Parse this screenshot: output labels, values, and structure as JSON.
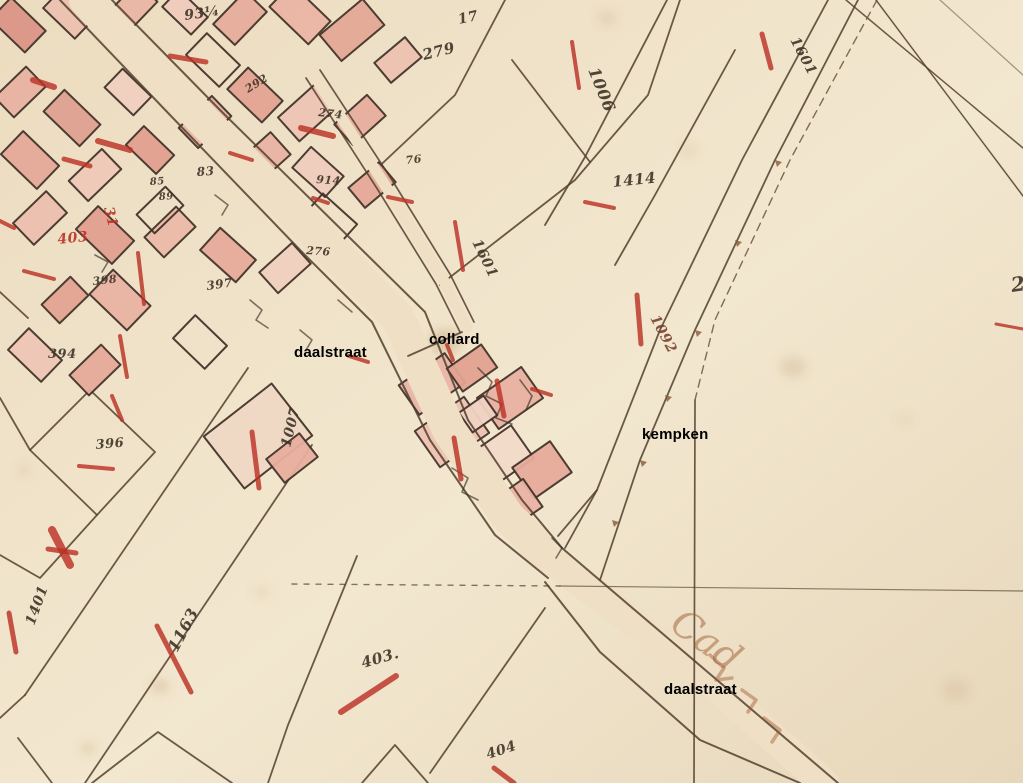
{
  "map_type": "historical cadastral map (scanned parchment with overlaid street/owner labels)",
  "palette": {
    "parchment": "#eedfc5",
    "parchment_light": "#f2e7cf",
    "parchment_dark": "#e7d7ba",
    "ink": "#52402e",
    "number_ink": "#3e3427",
    "building_fill": "#e9b6a8",
    "building_stroke": "#43332a",
    "red_ink": "#bb3226",
    "brown_ink": "#6b5340",
    "marginalia_ink": "#a05c34",
    "label_color": "#000000"
  },
  "labels": [
    {
      "text": "daalstraat",
      "x": 294,
      "y": 344
    },
    {
      "text": "collard",
      "x": 429,
      "y": 331
    },
    {
      "text": "kempken",
      "x": 642,
      "y": 426
    },
    {
      "text": "daalstraat",
      "x": 664,
      "y": 681
    }
  ],
  "marginalia": {
    "text": "Cad",
    "x": 668,
    "y": 628,
    "rot": 36,
    "size": 38
  },
  "numbers": [
    {
      "t": "93¼",
      "x": 185,
      "y": 20,
      "r": -8,
      "s": 14
    },
    {
      "t": "17",
      "x": 459,
      "y": 24,
      "r": -12,
      "s": 14
    },
    {
      "t": "279",
      "x": 424,
      "y": 60,
      "r": -14,
      "s": 15
    },
    {
      "t": "1006",
      "x": 588,
      "y": 70,
      "r": 68,
      "s": 16
    },
    {
      "t": "1601",
      "x": 790,
      "y": 40,
      "r": 62,
      "s": 14
    },
    {
      "t": "1601",
      "x": 472,
      "y": 242,
      "r": 64,
      "s": 14
    },
    {
      "t": "1414",
      "x": 613,
      "y": 187,
      "r": -6,
      "s": 15
    },
    {
      "t": "1092",
      "x": 650,
      "y": 318,
      "r": 62,
      "s": 14,
      "c": "#7a4331"
    },
    {
      "t": "26",
      "x": 1012,
      "y": 292,
      "r": -8,
      "s": 20
    },
    {
      "t": "83",
      "x": 197,
      "y": 176,
      "r": -4,
      "s": 12
    },
    {
      "t": "85",
      "x": 150,
      "y": 185,
      "r": -4,
      "s": 10
    },
    {
      "t": "89",
      "x": 159,
      "y": 200,
      "r": -4,
      "s": 10
    },
    {
      "t": "398",
      "x": 93,
      "y": 285,
      "r": -6,
      "s": 11
    },
    {
      "t": "397",
      "x": 207,
      "y": 290,
      "r": -8,
      "s": 12
    },
    {
      "t": "394",
      "x": 48,
      "y": 358,
      "r": 0,
      "s": 13
    },
    {
      "t": "274",
      "x": 318,
      "y": 116,
      "r": 6,
      "s": 11
    },
    {
      "t": "914",
      "x": 316,
      "y": 183,
      "r": 4,
      "s": 11
    },
    {
      "t": "76",
      "x": 406,
      "y": 164,
      "r": -6,
      "s": 11
    },
    {
      "t": "276",
      "x": 306,
      "y": 254,
      "r": 4,
      "s": 11
    },
    {
      "t": "292",
      "x": 248,
      "y": 93,
      "r": -32,
      "s": 11
    },
    {
      "t": "396",
      "x": 96,
      "y": 449,
      "r": -5,
      "s": 13
    },
    {
      "t": "1007",
      "x": 290,
      "y": 448,
      "r": -76,
      "s": 14
    },
    {
      "t": "1401",
      "x": 34,
      "y": 626,
      "r": -70,
      "s": 14
    },
    {
      "t": "1163",
      "x": 177,
      "y": 653,
      "r": -62,
      "s": 16
    },
    {
      "t": "403.",
      "x": 363,
      "y": 668,
      "r": -16,
      "s": 15
    },
    {
      "t": "404",
      "x": 488,
      "y": 759,
      "r": -18,
      "s": 14
    },
    {
      "t": "403",
      "x": 58,
      "y": 244,
      "r": -6,
      "s": 14,
      "c": "#bb3226"
    },
    {
      "t": "31",
      "x": 104,
      "y": 208,
      "r": 76,
      "s": 14,
      "c": "#bb3226"
    }
  ],
  "red_marks": [
    [
      572,
      42,
      579,
      88,
      4
    ],
    [
      762,
      34,
      771,
      68,
      5
    ],
    [
      455,
      222,
      463,
      270,
      4
    ],
    [
      585,
      202,
      614,
      208,
      4
    ],
    [
      637,
      295,
      641,
      344,
      5
    ],
    [
      996,
      324,
      1023,
      329,
      3
    ],
    [
      79,
      466,
      113,
      469,
      4
    ],
    [
      252,
      432,
      259,
      488,
      5
    ],
    [
      9,
      613,
      16,
      652,
      5
    ],
    [
      157,
      626,
      191,
      692,
      5
    ],
    [
      341,
      712,
      396,
      676,
      6
    ],
    [
      494,
      768,
      514,
      783,
      5
    ],
    [
      24,
      271,
      54,
      279,
      4
    ],
    [
      64,
      159,
      90,
      166,
      5
    ],
    [
      33,
      80,
      54,
      87,
      6
    ],
    [
      98,
      141,
      130,
      150,
      6
    ],
    [
      170,
      56,
      206,
      62,
      5
    ],
    [
      301,
      128,
      333,
      136,
      6
    ],
    [
      230,
      153,
      252,
      160,
      4
    ],
    [
      313,
      198,
      328,
      203,
      4
    ],
    [
      388,
      197,
      412,
      202,
      4
    ],
    [
      112,
      396,
      122,
      420,
      4
    ],
    [
      52,
      530,
      70,
      565,
      8
    ],
    [
      48,
      549,
      76,
      553,
      5
    ],
    [
      138,
      253,
      144,
      304,
      4
    ],
    [
      120,
      336,
      127,
      377,
      4
    ],
    [
      447,
      345,
      453,
      360,
      4
    ],
    [
      497,
      381,
      504,
      416,
      5
    ],
    [
      454,
      438,
      461,
      479,
      5
    ],
    [
      532,
      389,
      551,
      395,
      4
    ],
    [
      0,
      221,
      14,
      228,
      4
    ],
    [
      349,
      356,
      368,
      362,
      4
    ]
  ],
  "lines": [
    {
      "p": [
        248,
        368,
        25,
        695
      ],
      "l": 1
    },
    {
      "p": [
        312,
        445,
        85,
        783
      ],
      "l": 1
    },
    {
      "p": [
        30,
        450,
        90,
        390,
        155,
        452,
        97,
        515,
        30,
        450
      ],
      "l": 1
    },
    {
      "p": [
        0,
        398,
        30,
        450
      ],
      "l": 1
    },
    {
      "p": [
        97,
        515,
        40,
        578,
        0,
        555
      ],
      "l": 1
    },
    {
      "p": [
        25,
        695,
        0,
        718
      ],
      "l": 1
    },
    {
      "p": [
        18,
        738,
        52,
        783
      ],
      "l": 1
    },
    {
      "p": [
        92,
        783,
        158,
        732,
        232,
        783
      ],
      "l": 1
    },
    {
      "p": [
        362,
        783,
        395,
        745,
        428,
        783
      ],
      "l": 1
    },
    {
      "p": [
        357,
        556,
        288,
        725,
        268,
        783
      ],
      "l": 1
    },
    {
      "p": [
        430,
        773,
        545,
        608
      ],
      "l": 1
    },
    {
      "p": [
        0,
        292,
        28,
        318
      ],
      "l": 1
    },
    {
      "p": [
        846,
        0,
        1023,
        148
      ],
      "l": 1,
      "w": 1.5
    },
    {
      "p": [
        876,
        0,
        1023,
        196
      ],
      "l": 1,
      "w": 1.5
    },
    {
      "p": [
        940,
        0,
        1023,
        75
      ],
      "l": 1,
      "w": 1.2,
      "o": 0.5
    },
    {
      "p": [
        370,
        175,
        455,
        95,
        505,
        0
      ],
      "l": 1
    },
    {
      "p": [
        440,
        285,
        575,
        180,
        648,
        95,
        680,
        0
      ],
      "l": 1
    },
    {
      "p": [
        512,
        60,
        590,
        162
      ],
      "l": 1
    },
    {
      "p": [
        667,
        0,
        585,
        157,
        545,
        225
      ],
      "l": 1
    },
    {
      "p": [
        735,
        50,
        655,
        195,
        615,
        265
      ],
      "l": 1
    },
    {
      "p": [
        60,
        0,
        170,
        115,
        300,
        250,
        372,
        322,
        430,
        440,
        495,
        535,
        548,
        578
      ],
      "w": 2
    },
    {
      "p": [
        112,
        0,
        222,
        112,
        352,
        240,
        425,
        312,
        468,
        420,
        522,
        500,
        562,
        548
      ],
      "w": 2
    },
    {
      "p": [
        562,
        548,
        838,
        783
      ],
      "w": 2
    },
    {
      "p": [
        545,
        582,
        600,
        652,
        700,
        740,
        800,
        783
      ],
      "w": 2
    },
    {
      "p": [
        828,
        0,
        742,
        160,
        660,
        330,
        597,
        490,
        565,
        548
      ],
      "w": 1.8
    },
    {
      "p": [
        858,
        0,
        775,
        160,
        695,
        330,
        640,
        460,
        600,
        580
      ],
      "w": 1.8
    },
    {
      "p": [
        306,
        78,
        378,
        190,
        436,
        284,
        460,
        332
      ],
      "w": 1.7
    },
    {
      "p": [
        320,
        70,
        392,
        180,
        450,
        274,
        474,
        322
      ],
      "w": 1.7
    },
    {
      "p": [
        695,
        400,
        694,
        783
      ],
      "w": 1.7
    },
    {
      "p": [
        560,
        586,
        1023,
        591
      ],
      "w": 1.2,
      "o": 0.65
    },
    {
      "p": [
        292,
        584,
        560,
        586
      ],
      "w": 1.4,
      "d": "5 7",
      "o": 0.7
    },
    {
      "p": [
        877,
        0,
        790,
        160,
        715,
        320,
        695,
        400
      ],
      "w": 1.4,
      "d": "8 6",
      "c": "#6b5340"
    },
    {
      "p": [
        408,
        356,
        462,
        332
      ],
      "w": 1.8
    },
    {
      "p": [
        558,
        536,
        597,
        490
      ],
      "w": 1.8
    }
  ],
  "road_carves": [
    {
      "p": [
        86,
        0,
        196,
        113,
        326,
        245,
        398,
        318,
        449,
        430,
        508,
        517,
        555,
        563
      ],
      "w": 34
    },
    {
      "p": [
        555,
        563,
        700,
        672,
        824,
        783
      ],
      "w": 30
    },
    {
      "p": [
        313,
        74,
        385,
        185,
        443,
        279,
        467,
        327
      ],
      "w": 11
    }
  ],
  "buildings": [
    [
      18,
      25,
      48,
      30,
      44,
      "#dc9485"
    ],
    [
      68,
      14,
      44,
      26,
      44,
      "#ecc0b0"
    ],
    [
      130,
      10,
      50,
      28,
      -46,
      "#e9b6a6"
    ],
    [
      185,
      12,
      40,
      24,
      44,
      "#f0cbbb"
    ],
    [
      240,
      18,
      46,
      30,
      -46,
      "#e6ac9c"
    ],
    [
      300,
      14,
      54,
      32,
      44,
      "#eab5a5"
    ],
    [
      352,
      30,
      56,
      34,
      -40,
      "#e4a897"
    ],
    [
      398,
      60,
      40,
      26,
      -40,
      "#edc1b1"
    ],
    [
      20,
      92,
      44,
      28,
      -44,
      "#e8b2a2"
    ],
    [
      72,
      118,
      50,
      30,
      44,
      "#dfa191"
    ],
    [
      128,
      92,
      40,
      26,
      44,
      "#f1d0c0"
    ],
    [
      205,
      122,
      46,
      28,
      -44,
      "#e9b7a7"
    ],
    [
      255,
      95,
      48,
      30,
      44,
      "#e3a493"
    ],
    [
      308,
      112,
      52,
      32,
      -42,
      "#eec5b5"
    ],
    [
      360,
      120,
      44,
      28,
      -42,
      "#e7ae9e"
    ],
    [
      30,
      160,
      50,
      32,
      44,
      "#e5a999"
    ],
    [
      95,
      175,
      46,
      28,
      -44,
      "#efc9b9"
    ],
    [
      150,
      150,
      42,
      26,
      44,
      "#e2a090"
    ],
    [
      262,
      160,
      50,
      30,
      -42,
      "#e8b3a3"
    ],
    [
      318,
      172,
      44,
      28,
      42,
      "#f0cdbd"
    ],
    [
      372,
      185,
      40,
      26,
      -40,
      "#e5a898"
    ],
    [
      40,
      218,
      46,
      30,
      -44,
      "#ecbfaf"
    ],
    [
      105,
      235,
      50,
      32,
      44,
      "#e1a090"
    ],
    [
      170,
      232,
      44,
      28,
      -44,
      "#eabaa9"
    ],
    [
      228,
      255,
      48,
      30,
      42,
      "#e6ab9b"
    ],
    [
      285,
      268,
      44,
      28,
      -42,
      "#f0cfbf"
    ],
    [
      120,
      300,
      52,
      34,
      44,
      "#e8b4a4"
    ],
    [
      65,
      300,
      40,
      26,
      -44,
      "#e3a393"
    ],
    [
      35,
      355,
      46,
      30,
      44,
      "#eec6b6"
    ],
    [
      95,
      370,
      44,
      28,
      -44,
      "#e6aa9a"
    ],
    [
      213,
      60,
      46,
      30,
      44,
      "none"
    ],
    [
      160,
      210,
      40,
      26,
      -44,
      "none"
    ],
    [
      330,
      220,
      46,
      30,
      42,
      "none"
    ],
    [
      200,
      342,
      44,
      32,
      44,
      "none"
    ],
    [
      258,
      436,
      86,
      66,
      -38,
      "#f0d8c3"
    ],
    [
      292,
      458,
      42,
      30,
      -38,
      "#e7ae9e"
    ],
    [
      432,
      384,
      56,
      36,
      -35,
      "#e9b6a8"
    ],
    [
      472,
      368,
      42,
      28,
      -35,
      "#e2a392"
    ],
    [
      510,
      398,
      54,
      38,
      -35,
      "#e8b1a2"
    ],
    [
      452,
      432,
      60,
      44,
      -35,
      "#eec2b4"
    ],
    [
      502,
      456,
      50,
      40,
      -35,
      "#f3dbc9"
    ],
    [
      542,
      470,
      46,
      38,
      -35,
      "#e6ab9b"
    ],
    [
      514,
      506,
      46,
      34,
      -35,
      "#eab4a5"
    ],
    [
      478,
      414,
      30,
      24,
      -35,
      "#f1d2c2"
    ]
  ],
  "scribbles": [
    {
      "p": [
        478,
        368,
        492,
        382,
        486,
        396,
        502,
        404,
        496,
        418,
        512,
        424
      ]
    },
    {
      "p": [
        520,
        380,
        532,
        396,
        526,
        410
      ]
    },
    {
      "p": [
        452,
        468,
        468,
        478,
        462,
        492,
        478,
        500
      ]
    },
    {
      "p": [
        215,
        195,
        228,
        205,
        222,
        215
      ]
    },
    {
      "p": [
        250,
        300,
        262,
        310,
        256,
        320,
        268,
        328
      ]
    },
    {
      "p": [
        300,
        330,
        312,
        340,
        306,
        350
      ]
    },
    {
      "p": [
        338,
        300,
        352,
        312
      ]
    },
    {
      "p": [
        95,
        255,
        108,
        262,
        102,
        272
      ]
    },
    {
      "p": [
        552,
        538,
        562,
        548,
        556,
        558
      ]
    }
  ],
  "marginalia_tail": [
    {
      "p": [
        710,
        655,
        724,
        668,
        716,
        680,
        732,
        678
      ]
    },
    {
      "p": [
        742,
        690,
        756,
        700,
        748,
        712
      ]
    },
    {
      "p": [
        764,
        718,
        780,
        730,
        772,
        742
      ]
    }
  ],
  "survey_ticks": [
    [
      775,
      160
    ],
    [
      735,
      240
    ],
    [
      695,
      330
    ],
    [
      665,
      395
    ],
    [
      640,
      460
    ],
    [
      612,
      520
    ]
  ],
  "stains": [
    [
      445,
      342,
      16,
      13,
      0.28
    ],
    [
      793,
      367,
      13,
      10,
      0.18
    ],
    [
      160,
      686,
      9,
      7,
      0.22
    ],
    [
      88,
      748,
      7,
      6,
      0.2
    ],
    [
      607,
      18,
      9,
      7,
      0.15
    ],
    [
      956,
      690,
      14,
      11,
      0.12
    ],
    [
      688,
      150,
      10,
      8,
      0.1
    ],
    [
      262,
      592,
      8,
      6,
      0.12
    ],
    [
      24,
      470,
      6,
      5,
      0.15
    ],
    [
      905,
      420,
      7,
      5,
      0.1
    ]
  ]
}
